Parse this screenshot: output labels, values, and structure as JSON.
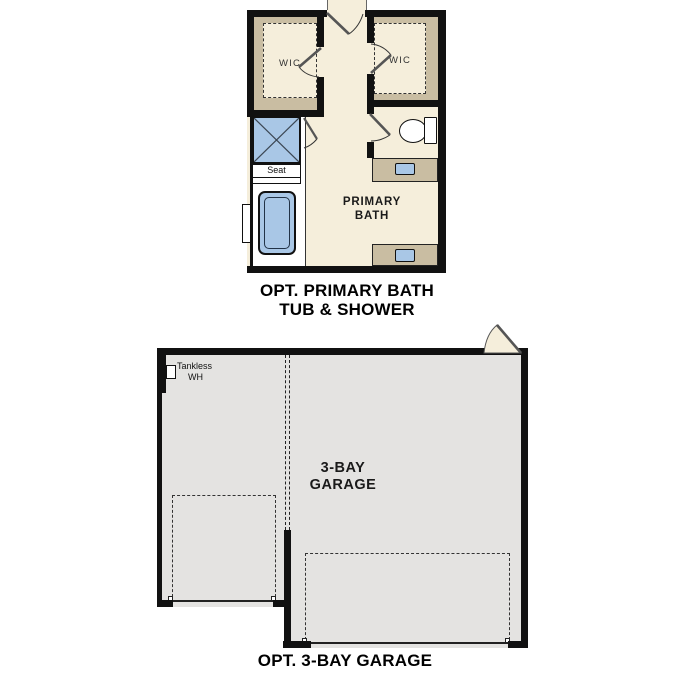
{
  "colors": {
    "page_bg": "#ffffff",
    "floor_cream": "#f5eedb",
    "wall_tan": "#c9bda2",
    "fixture_blue": "#a9c7e6",
    "garage_floor": "#e4e3e1",
    "wall_black": "#111111"
  },
  "bath_plan": {
    "caption": {
      "line1": "OPT. PRIMARY BATH",
      "line2": "TUB & SHOWER"
    },
    "room_label": {
      "line1": "PRIMARY",
      "line2": "BATH"
    },
    "wic_left_label": "WIC",
    "wic_right_label": "WIC",
    "seat_label": "Seat"
  },
  "garage_plan": {
    "caption": "OPT. 3-BAY GARAGE",
    "room_label": {
      "line1": "3-BAY",
      "line2": "GARAGE"
    },
    "tankless_label": {
      "line1": "Tankless",
      "line2": "WH"
    }
  }
}
